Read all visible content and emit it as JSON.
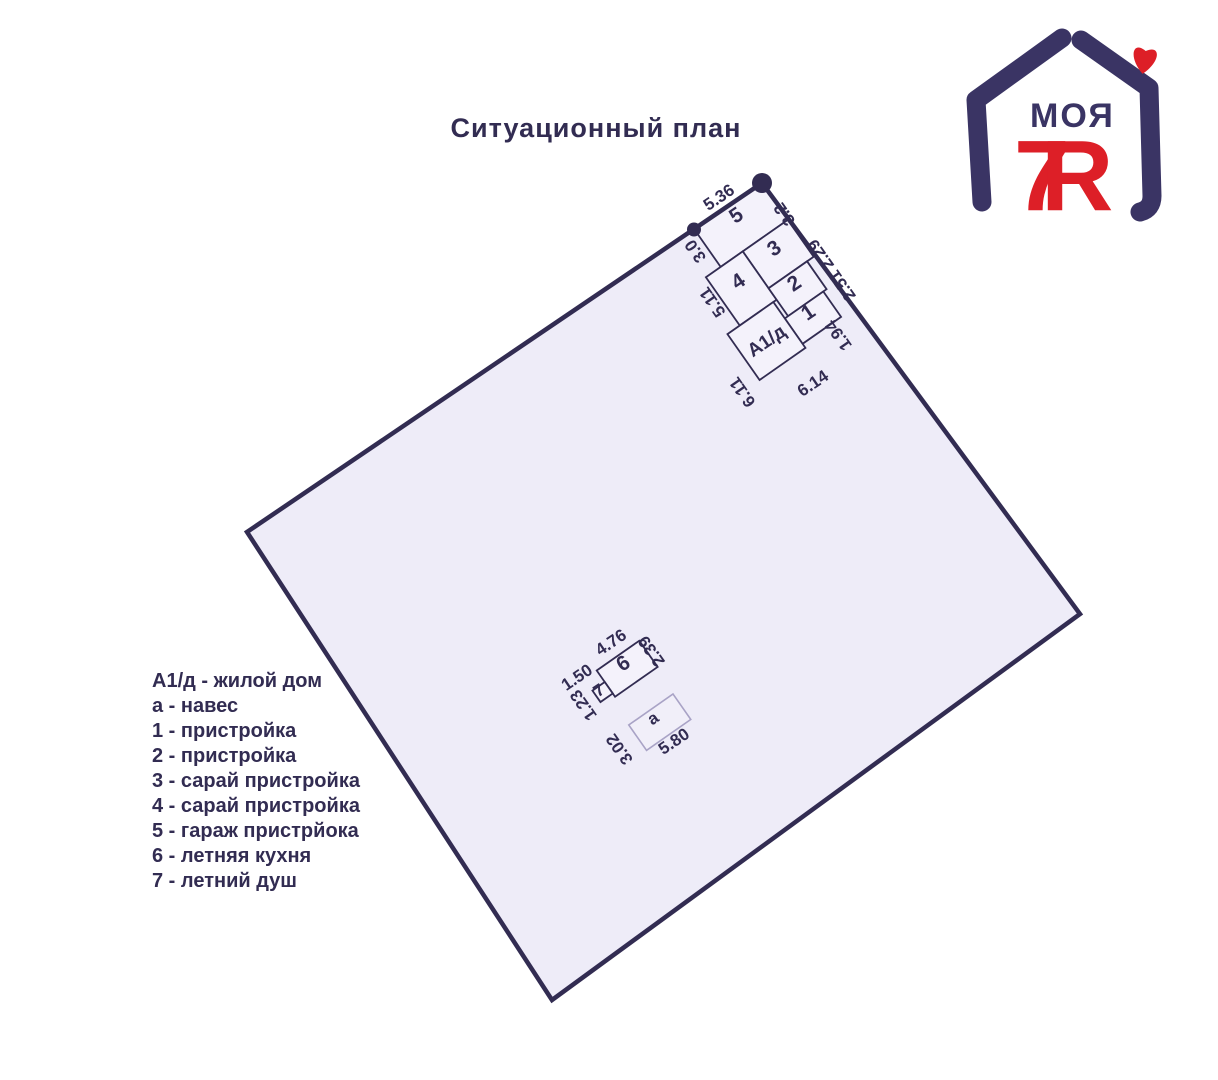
{
  "title": "Ситуационный план",
  "logo": {
    "text_top": "МОЯ",
    "text_7": "7",
    "text_ya": "Я"
  },
  "legend": {
    "items": [
      "А1/д - жилой дом",
      "а - навес",
      "1 - пристройка",
      "2 - пристройка",
      "3 - сарай пристройка",
      "4 - сарай пристройка",
      "5 - гараж пристрйока",
      "6 - летняя кухня",
      "7 - летний душ"
    ]
  },
  "plan": {
    "rooms": {
      "r5": "5",
      "r3": "3",
      "r4": "4",
      "r2": "2",
      "r1": "1",
      "house": "А1/д",
      "r6": "6",
      "r7": "7",
      "shed": "a"
    },
    "dims": {
      "d536": "5.36",
      "d32": "3.2",
      "d251229": "2.51 2.29",
      "d194": "1.94",
      "d30": "3.0",
      "d511": "5.11",
      "d611": "6.11",
      "d614": "6.14",
      "d476": "4.76",
      "d239": "2.39",
      "d150": "1.50",
      "d123": "1.23",
      "d302": "3.02",
      "d580": "5.80"
    }
  },
  "colors": {
    "ink": "#322C52",
    "plot_fill": "#EEECF8",
    "room_fill": "#F4F2FB",
    "logo_purple": "#3A3464",
    "logo_red": "#DD1F27"
  }
}
